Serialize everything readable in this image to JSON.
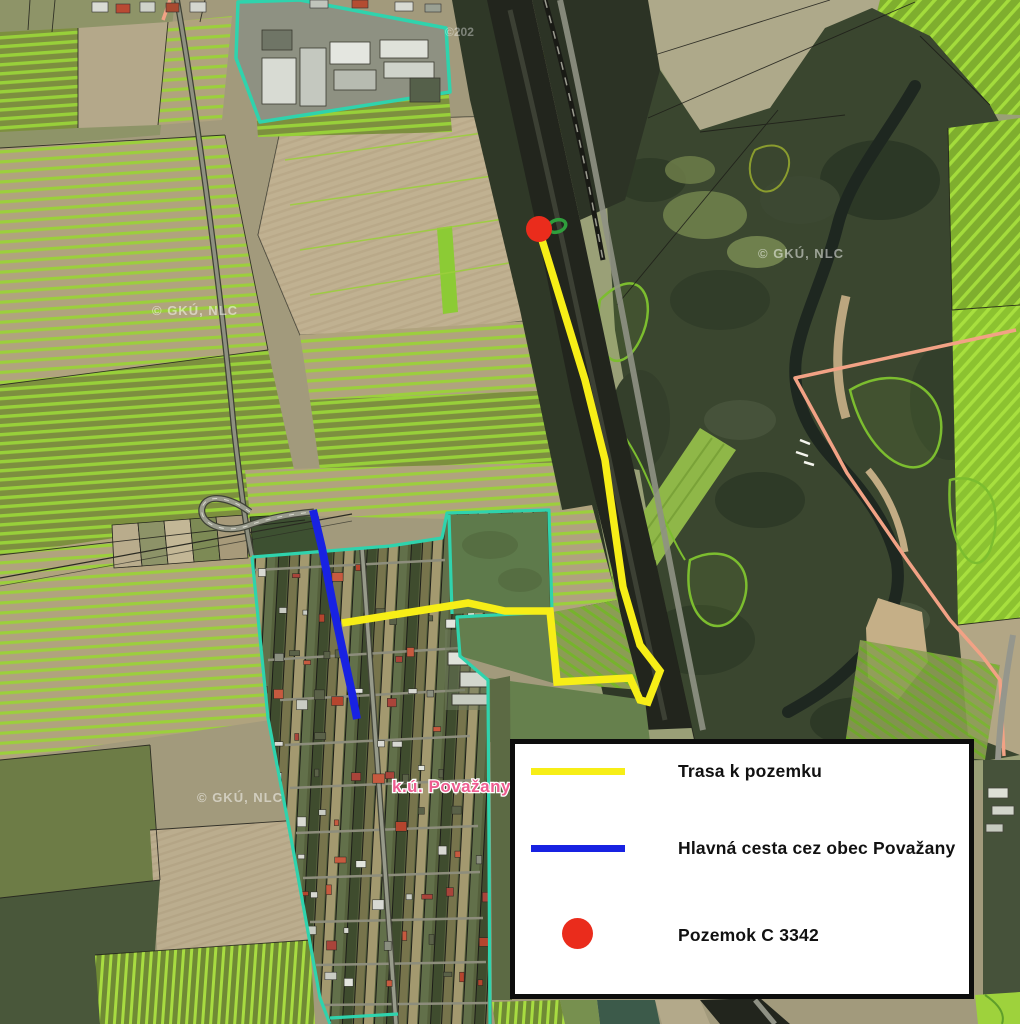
{
  "map": {
    "region_label": {
      "text": "k.ú. Považany",
      "color": "#ee5d90"
    },
    "watermarks": [
      {
        "text": "© GKÚ, NLC",
        "x": 152,
        "y": 315
      },
      {
        "text": "© GKÚ, NLC",
        "x": 758,
        "y": 258
      },
      {
        "text": "© GKÚ, NLC",
        "x": 197,
        "y": 802
      },
      {
        "text": "©202",
        "x": 445,
        "y": 36
      }
    ],
    "overlays": {
      "route_to_parcel": {
        "color": "#f7ee17",
        "points": [
          [
            539,
            230
          ],
          [
            585,
            380
          ],
          [
            605,
            460
          ],
          [
            623,
            587
          ],
          [
            640,
            645
          ],
          [
            660,
            671
          ],
          [
            648,
            702
          ],
          [
            640,
            700
          ],
          [
            630,
            678
          ],
          [
            557,
            682
          ],
          [
            550,
            611
          ],
          [
            505,
            611
          ],
          [
            468,
            603
          ],
          [
            342,
            623
          ]
        ]
      },
      "main_road": {
        "color": "#1822e2",
        "points": [
          [
            313,
            510
          ],
          [
            322,
            548
          ],
          [
            333,
            605
          ],
          [
            343,
            652
          ],
          [
            352,
            693
          ],
          [
            357,
            719
          ]
        ]
      },
      "parcel_marker": {
        "color": "#ea2c1c",
        "cx": 539,
        "cy": 229,
        "r": 13
      }
    }
  },
  "legend": {
    "items": [
      {
        "symbol": "line",
        "color": "#f7ee17",
        "label": "Trasa k pozemku"
      },
      {
        "symbol": "line",
        "color": "#1822e2",
        "label": "Hlavná cesta cez obec Považany"
      },
      {
        "symbol": "dot",
        "color": "#ea2c1c",
        "label": "Pozemok C 3342"
      }
    ]
  }
}
